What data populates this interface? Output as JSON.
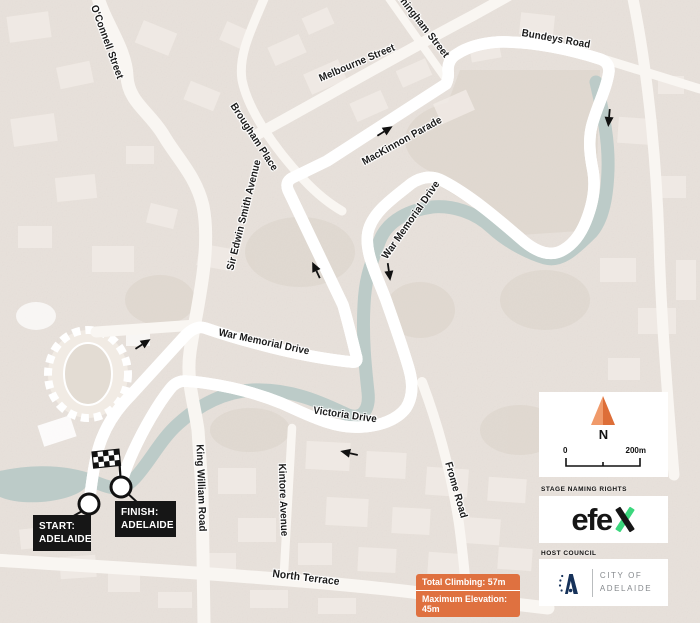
{
  "map": {
    "streets": {
      "o_connell": "O'Connell Street",
      "brougham_place": "Brougham Place",
      "melbourne": "Melbourne Street",
      "jerningham": "Jerningham Street",
      "bundeys": "Bundeys Road",
      "mackinnon": "MacKinnon Parade",
      "war_memorial_upper": "War Memorial Drive",
      "war_memorial_lower": "War Memorial Drive",
      "sir_edwin_smith": "Sir Edwin Smith Avenue",
      "victoria": "Victoria Drive",
      "king_william": "King William Road",
      "kintore": "Kintore Avenue",
      "frome": "Frome Road",
      "north_terrace": "North Terrace"
    },
    "colors": {
      "route": "#E0713C",
      "water": "#BCCBC8",
      "road": "#F9F6F2",
      "background": "#E8E1DB",
      "marker_box": "#161616"
    }
  },
  "markers": {
    "start": {
      "label_line1": "START:",
      "label_line2": "ADELAIDE"
    },
    "finish": {
      "label_line1": "FINISH:",
      "label_line2": "ADELAIDE"
    }
  },
  "legend": {
    "north_label": "N",
    "scale": {
      "min": "0",
      "max": "200m"
    }
  },
  "stats": {
    "total_climbing": "Total Climbing: 57m",
    "maximum_elevation": "Maximum Elevation: 45m"
  },
  "sponsor": {
    "header": "STAGE NAMING RIGHTS",
    "name": "efex",
    "name_part_black": "efe",
    "name_part_x": "x",
    "x_green": "#3BD77D"
  },
  "council": {
    "header": "HOST COUNCIL",
    "line1": "CITY OF",
    "line2": "ADELAIDE",
    "navy": "#16325A"
  }
}
